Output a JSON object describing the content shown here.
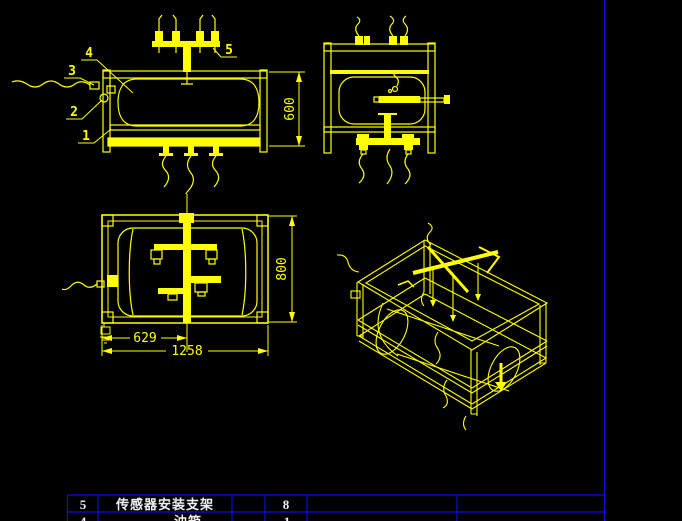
{
  "drawing_area": {
    "balloons": {
      "b1": "1",
      "b2": "2",
      "b3": "3",
      "b4": "4",
      "b5": "5"
    },
    "dimensions": {
      "front_height": "600",
      "plan_half_width": "629",
      "plan_width": "1258",
      "plan_depth": "800"
    }
  },
  "bom_table": {
    "rows": [
      {
        "no": "5",
        "name": "传感器安装支架",
        "qty": "8"
      },
      {
        "no": "4",
        "name": "油箱",
        "qty": "1"
      }
    ]
  },
  "colors": {
    "cad_line": "#ffff00",
    "sheet_border": "#0d0de0",
    "table_text": "#f0f0f0",
    "background": "#000000"
  }
}
